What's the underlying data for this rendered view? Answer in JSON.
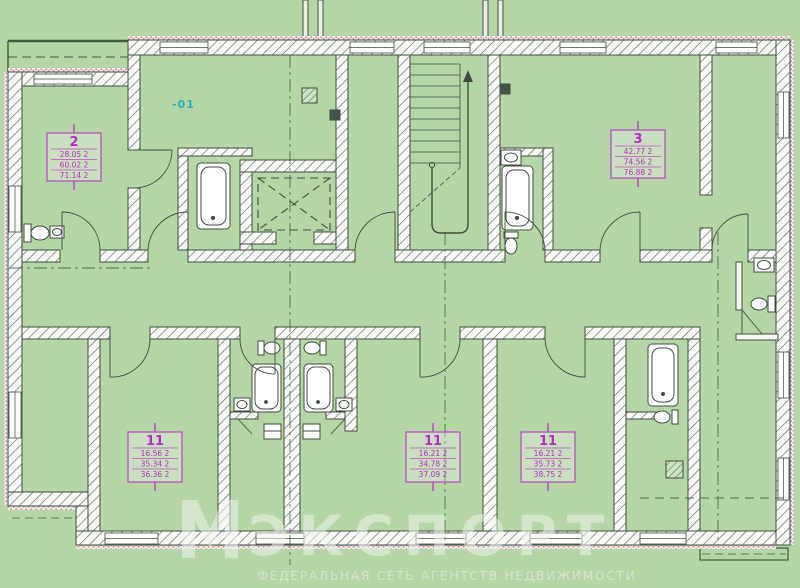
{
  "plan": {
    "level_mark": "-01",
    "stamps": [
      {
        "number": "2",
        "rows": [
          "28.05 2",
          "60.02 2",
          "71.14 2"
        ]
      },
      {
        "number": "3",
        "rows": [
          "42.77 2",
          "74.56 2",
          "76.88 2"
        ]
      },
      {
        "number": "11",
        "rows": [
          "16.56 2",
          "35.34 2",
          "36.36 2"
        ]
      },
      {
        "number": "11",
        "rows": [
          "16.21 2",
          "34.78 2",
          "37.09 2"
        ]
      },
      {
        "number": "11",
        "rows": [
          "16.21 2",
          "35.73 2",
          "38.75 2"
        ]
      }
    ]
  },
  "watermark": {
    "brand": "ЭКСПОРТ",
    "subtitle": "ФЕДЕРАЛЬНАЯ СЕТЬ АГЕНТСТВ НЕДВИЖИМОСТИ"
  },
  "colors": {
    "background": "#b5d6a6",
    "wall_line": "#3e4e3e",
    "stamp_magenta": "#b32cc4",
    "level_cyan": "#2fa8bc",
    "insulation_pink": "#c9909e"
  }
}
